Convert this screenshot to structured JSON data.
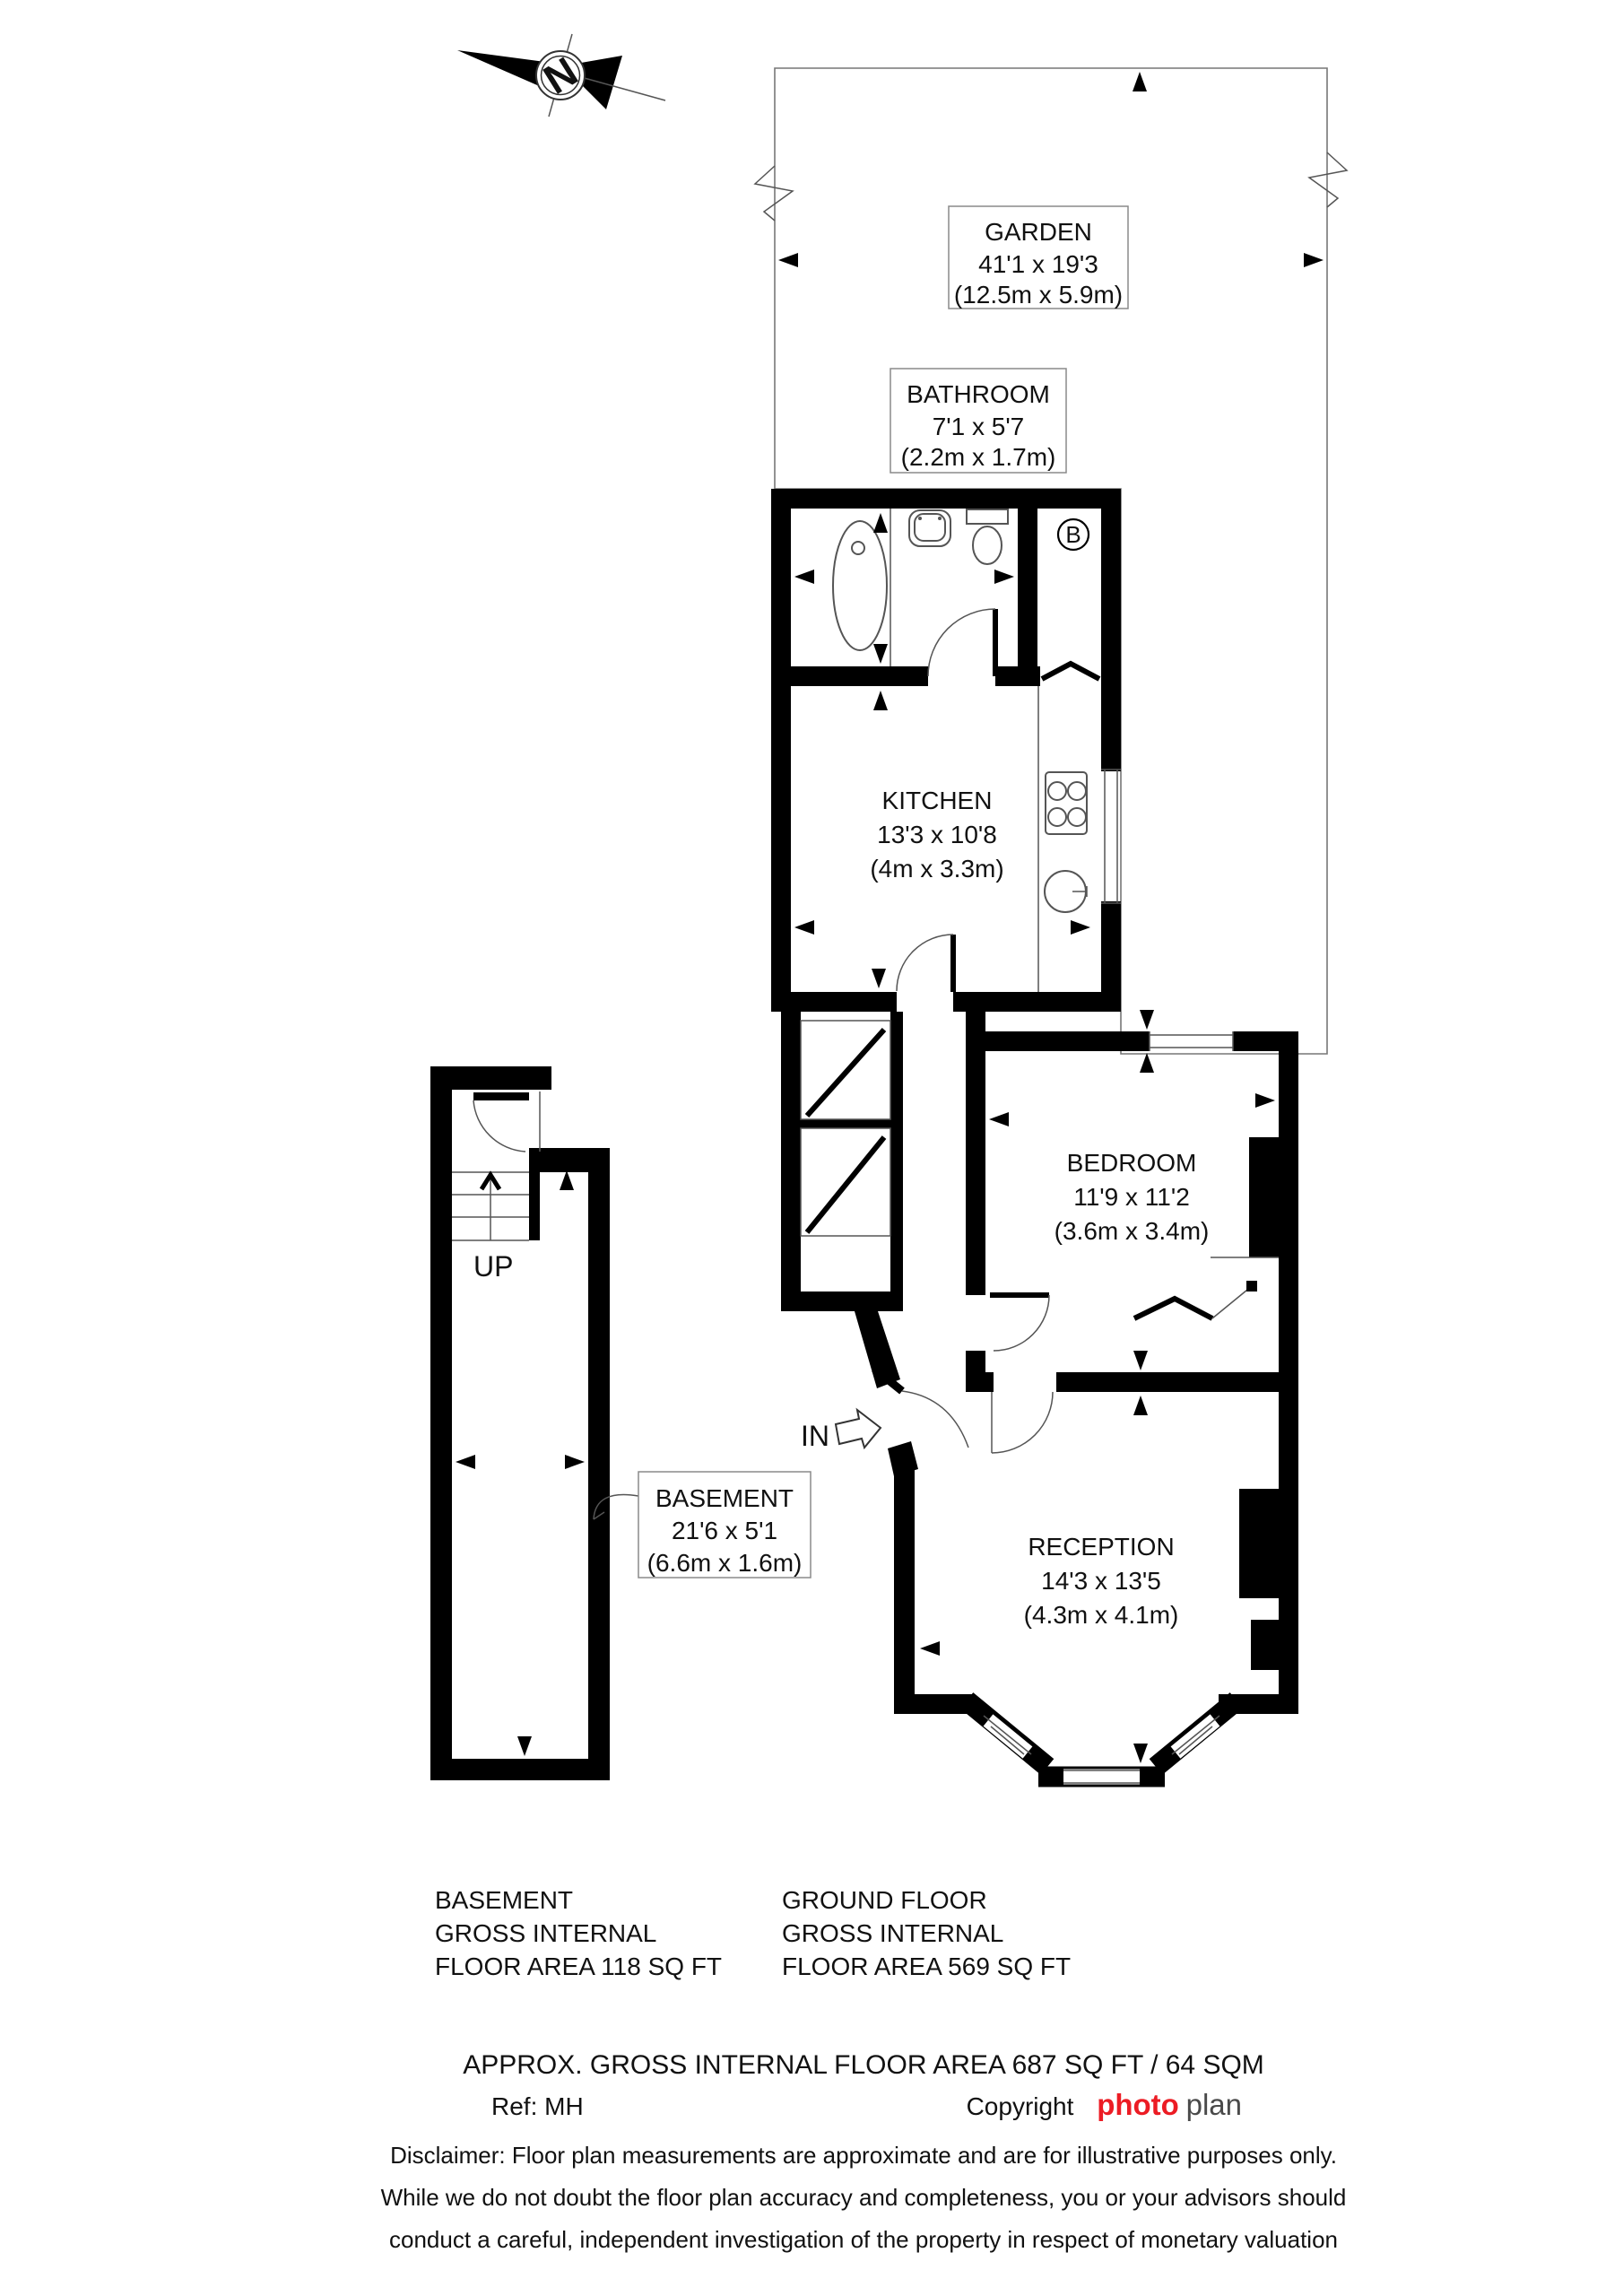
{
  "compass": {
    "label": "N"
  },
  "rooms": {
    "garden": {
      "name": "GARDEN",
      "size_imperial": "41'1 x 19'3",
      "size_metric": "(12.5m x 5.9m)"
    },
    "bathroom": {
      "name": "BATHROOM",
      "size_imperial": "7'1 x 5'7",
      "size_metric": "(2.2m x 1.7m)"
    },
    "kitchen": {
      "name": "KITCHEN",
      "size_imperial": "13'3 x 10'8",
      "size_metric": "(4m x 3.3m)"
    },
    "bedroom": {
      "name": "BEDROOM",
      "size_imperial": "11'9 x 11'2",
      "size_metric": "(3.6m x 3.4m)"
    },
    "reception": {
      "name": "RECEPTION",
      "size_imperial": "14'3 x 13'5",
      "size_metric": "(4.3m x 4.1m)"
    },
    "basement": {
      "name": "BASEMENT",
      "size_imperial": "21'6 x 5'1",
      "size_metric": "(6.6m x 1.6m)"
    }
  },
  "annotations": {
    "stairs_up": "UP",
    "entrance": "IN",
    "boiler": "B"
  },
  "area_summary": {
    "basement": {
      "line1": "BASEMENT",
      "line2": "GROSS INTERNAL",
      "line3": "FLOOR AREA 118 SQ FT"
    },
    "ground_floor": {
      "line1": "GROUND FLOOR",
      "line2": "GROSS INTERNAL",
      "line3": "FLOOR AREA 569 SQ FT"
    },
    "total": "APPROX. GROSS INTERNAL FLOOR AREA 687 SQ FT / 64 SQM"
  },
  "footer": {
    "reference": "Ref: MH",
    "copyright_label": "Copyright",
    "brand_part1": "photo",
    "brand_part2": "plan",
    "disclaimer_line1": "Disclaimer: Floor plan measurements are approximate and are for illustrative purposes only.",
    "disclaimer_line2": "While we do not doubt the floor plan accuracy and completeness, you or your advisors should",
    "disclaimer_line3": "conduct a careful, independent investigation of the property in respect of monetary valuation"
  },
  "colors": {
    "wall": "#000000",
    "thin_line": "#555555",
    "hatch_line": "#777777",
    "brand_red": "#ec1c24",
    "brand_gray": "#4a4a4a",
    "text": "#111111"
  }
}
